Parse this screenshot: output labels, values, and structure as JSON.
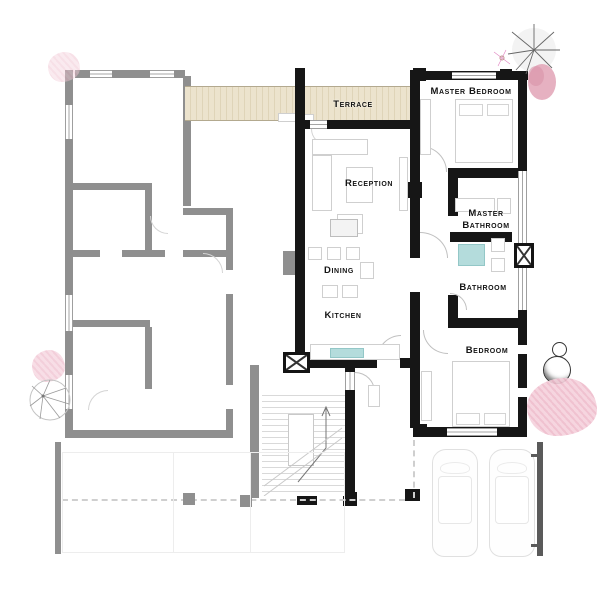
{
  "plan": {
    "title": "Apartment floor plan",
    "rooms": {
      "terrace": "Terrace",
      "reception": "Reception",
      "master_bedroom": "Master Bedroom",
      "master_bathroom_line1": "Master",
      "master_bathroom_line2": "Bathroom",
      "bathroom": "Bathroom",
      "dining": "Dining",
      "kitchen": "Kitchen",
      "bedroom": "Bedroom"
    },
    "colors": {
      "wall_main": "#161616",
      "wall_neighbor": "#8f8f8f",
      "wall_dark_gray": "#5a5a5a",
      "furniture_outline": "#cfcfcf",
      "terrace_fill": "#ece3cd",
      "terrace_stripe": "#dfd4b8",
      "fixture_teal": "#b4dcdc",
      "foliage_pink": "#f5d0db",
      "label_text": "#141414"
    },
    "decorations": {
      "trees": [
        "tree-icon (top-right)",
        "tree-icon (left)"
      ],
      "flowers": [
        "flower-icon (top-left)",
        "flower-icon (left)",
        "flower-icon (right)",
        "flower-icon (top-right)"
      ],
      "stones": "stone-circles (right)",
      "cars": 2
    }
  }
}
